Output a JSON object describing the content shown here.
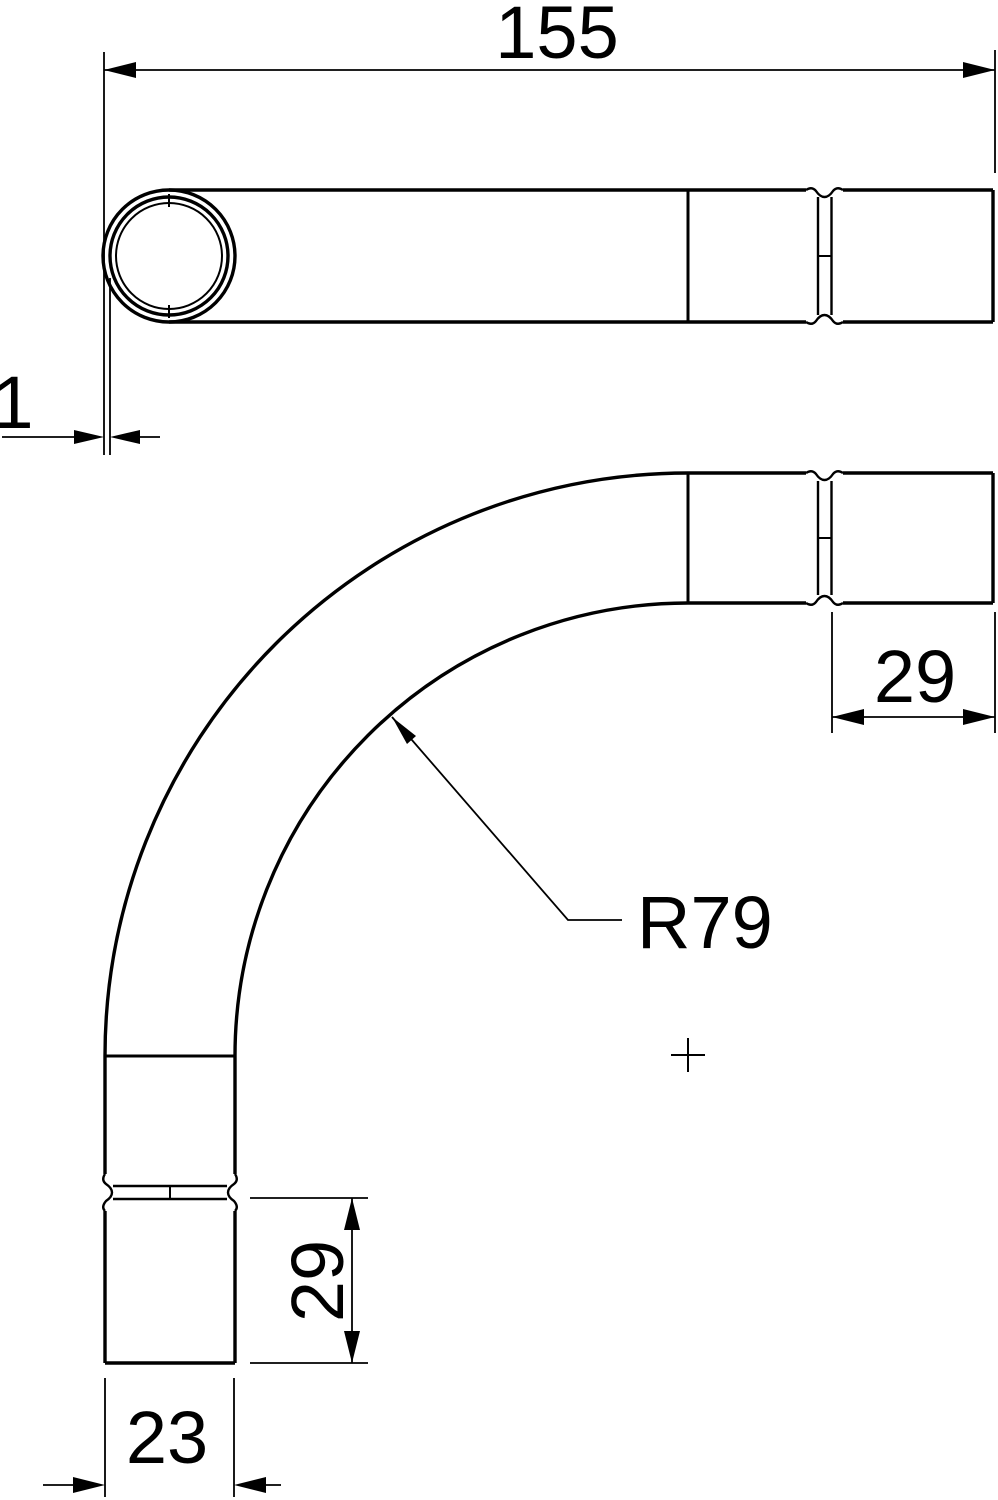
{
  "drawing": {
    "type": "technical-dimension-drawing",
    "subject": "90-degree conduit bend with socket ends, two orthographic views",
    "background_color": "#ffffff",
    "line_color": "#000000",
    "labels": {
      "overall_length": "155",
      "wall_thickness": "1",
      "socket_length_right": "29",
      "bend_radius": "R79",
      "socket_length_bottom": "29",
      "outer_diameter": "23"
    }
  }
}
